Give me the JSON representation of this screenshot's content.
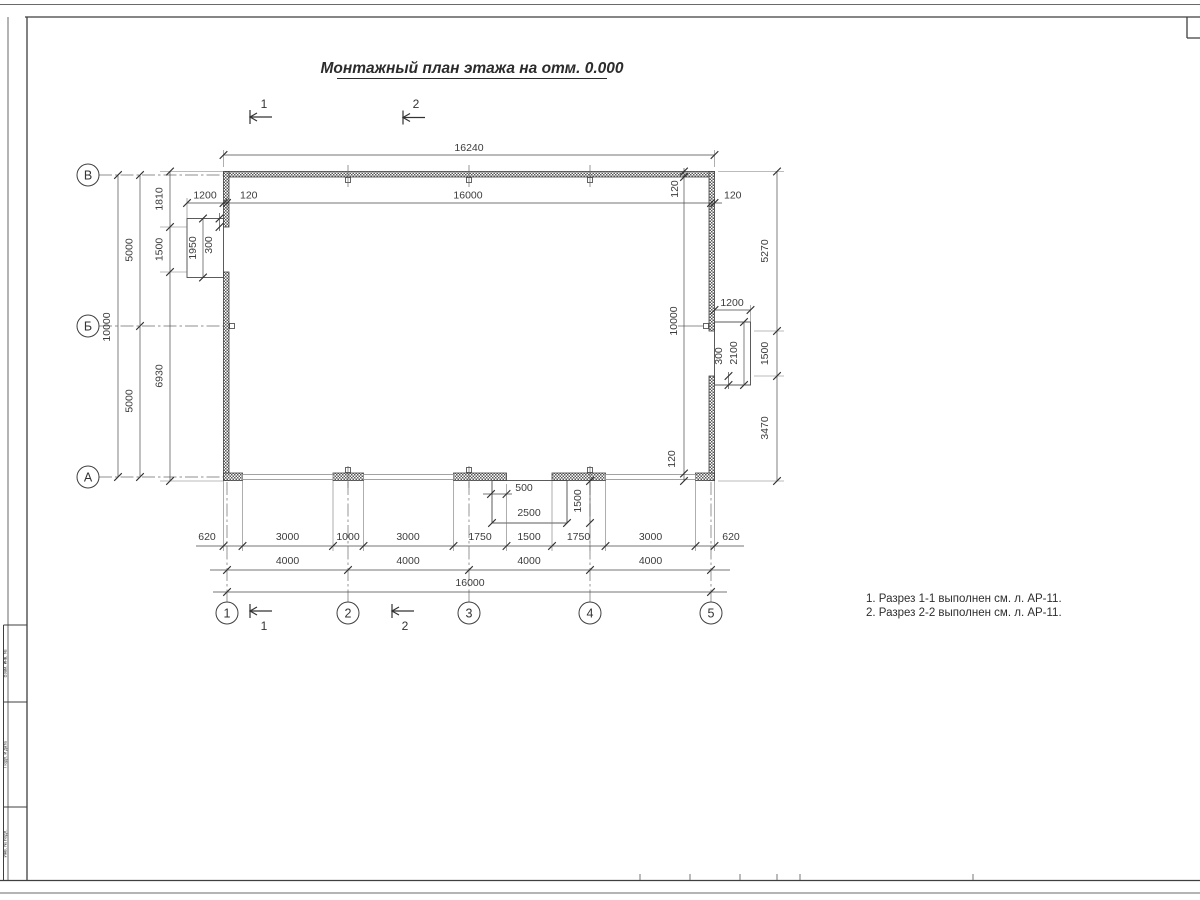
{
  "title": "Монтажный план этажа на отм. 0.000",
  "notes": {
    "line1": "1. Разрез 1-1 выполнен см. л. АР-11.",
    "line2": "2. Разрез 2-2 выполнен см. л. АР-11."
  },
  "axes": {
    "v1": "В",
    "v2": "Б",
    "v3": "А",
    "h1": "1",
    "h2": "2",
    "h3": "3",
    "h4": "4",
    "h5": "5"
  },
  "sections": {
    "s1": "1",
    "s2": "2"
  },
  "dims": {
    "overall_top": "16240",
    "top_1200": "1200",
    "top_120a": "120",
    "top_16000": "16000",
    "top_120b": "120",
    "top_120c": "120",
    "left_10000": "10000",
    "left_5000a": "5000",
    "left_5000b": "5000",
    "left_1810": "1810",
    "left_1500": "1500",
    "left_6930": "6930",
    "landL_1950": "1950",
    "landL_300": "300",
    "right_10000": "10000",
    "right_120a": "120",
    "right_120b": "120",
    "right_5270": "5270",
    "right_1500": "1500",
    "right_3470": "3470",
    "landR_1200": "1200",
    "landR_2100": "2100",
    "landR_300": "300",
    "porch_500": "500",
    "porch_2500": "2500",
    "porch_1500": "1500",
    "b1_620a": "620",
    "b1_3000a": "3000",
    "b1_1000": "1000",
    "b1_3000b": "3000",
    "b1_1750a": "1750",
    "b1_1500": "1500",
    "b1_1750b": "1750",
    "b1_3000c": "3000",
    "b1_620b": "620",
    "b2_4000a": "4000",
    "b2_4000b": "4000",
    "b2_4000c": "4000",
    "b2_4000d": "4000",
    "b3_16000": "16000"
  },
  "stamp": {
    "cell1": "Взам. инв. №",
    "cell2": "Подп. и дата",
    "cell3": "Инв. № подл."
  },
  "colors": {
    "line": "#444444",
    "dim_text": "#3c3c3c",
    "wall_hatch": "#555555"
  }
}
